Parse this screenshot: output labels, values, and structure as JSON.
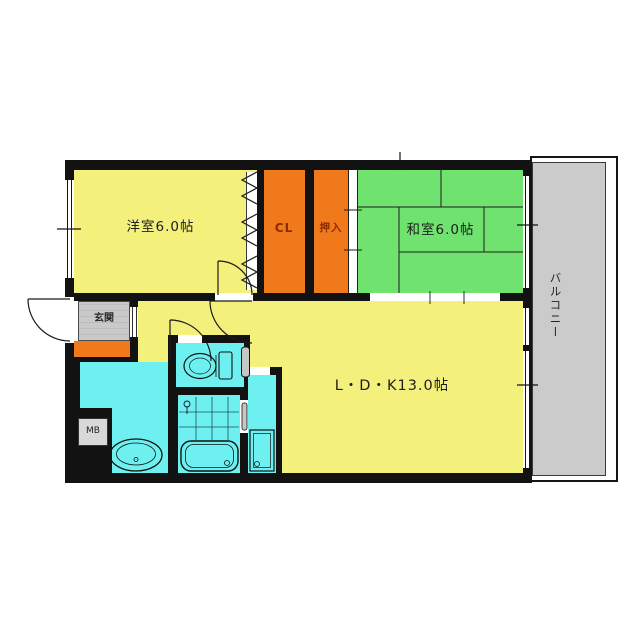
{
  "plan": {
    "title": "apartment-floor-plan",
    "rooms": {
      "western_room": "洋室6.0帖",
      "closet": "CL",
      "oshiire": "押入",
      "japanese_room": "和室6.0帖",
      "ldk": "L・D・K13.0帖",
      "balcony": "バルコニー",
      "entrance": "玄関",
      "meter_box": "MB"
    },
    "colors": {
      "room_yellow": "#F3F07C",
      "room_green": "#6FE26F",
      "closet_orange": "#F0791B",
      "wet_cyan": "#6FF0F0",
      "balcony_gray": "#CBCBCB",
      "label_gray": "#C9C9C9",
      "wall_black": "#121212",
      "closet_text": "#8A2B00",
      "text_color": "#1D1D1D"
    }
  }
}
